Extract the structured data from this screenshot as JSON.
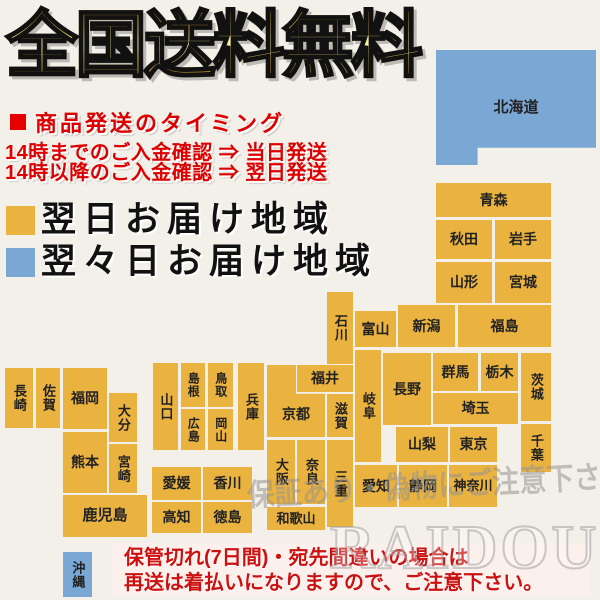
{
  "title": "全国送料無料",
  "shipping": {
    "heading": "商品発送のタイミング",
    "line1": "14時までのご入金確認 ⇒ 当日発送",
    "line2": "14時以降のご入金確認 ⇒ 翌日発送"
  },
  "legend": {
    "next_day": {
      "label": "翌日お届け地域",
      "color": "#eab23f"
    },
    "two_days": {
      "label": "翌々日お届け地域",
      "color": "#7ba7d5"
    }
  },
  "watermark": {
    "brush_text": "保証あり・偽物にご注意下さい",
    "brand_text": "RAIDOU"
  },
  "notice": {
    "line1": "保管切れ(7日間)・宛先間違いの場合は",
    "line2": "再送は着払いになりますので、ご注意下さい。"
  },
  "map": {
    "colors": {
      "orange": "#eab23f",
      "blue": "#7ba7d5"
    },
    "regions": [
      {
        "id": "hokkaido",
        "label": "北海道",
        "x": 436,
        "y": 50,
        "w": 160,
        "h": 115,
        "color": "blue",
        "orient": "h",
        "fs": 15,
        "clip": "hokkaido"
      },
      {
        "id": "aomori",
        "label": "青森",
        "x": 436,
        "y": 183,
        "w": 115,
        "h": 34
      },
      {
        "id": "akita",
        "label": "秋田",
        "x": 436,
        "y": 220,
        "w": 56,
        "h": 39
      },
      {
        "id": "iwate",
        "label": "岩手",
        "x": 495,
        "y": 220,
        "w": 56,
        "h": 39
      },
      {
        "id": "yamagata",
        "label": "山形",
        "x": 436,
        "y": 262,
        "w": 56,
        "h": 41
      },
      {
        "id": "miyagi",
        "label": "宮城",
        "x": 495,
        "y": 262,
        "w": 56,
        "h": 41
      },
      {
        "id": "niigata",
        "label": "新潟",
        "x": 398,
        "y": 305,
        "w": 57,
        "h": 42
      },
      {
        "id": "fukushima",
        "label": "福島",
        "x": 458,
        "y": 305,
        "w": 93,
        "h": 42
      },
      {
        "id": "toyama",
        "label": "富山",
        "x": 355,
        "y": 311,
        "w": 41,
        "h": 36
      },
      {
        "id": "ishikawa",
        "label": "石川",
        "x": 327,
        "y": 292,
        "w": 26,
        "h": 72,
        "orient": "v",
        "fs": 13
      },
      {
        "id": "gunma",
        "label": "群馬",
        "x": 433,
        "y": 353,
        "w": 45,
        "h": 38
      },
      {
        "id": "tochigi",
        "label": "栃木",
        "x": 481,
        "y": 353,
        "w": 37,
        "h": 38
      },
      {
        "id": "ibaraki",
        "label": "茨城",
        "x": 521,
        "y": 353,
        "w": 30,
        "h": 68,
        "orient": "v",
        "fs": 13
      },
      {
        "id": "saitama",
        "label": "埼玉",
        "x": 433,
        "y": 393,
        "w": 85,
        "h": 31
      },
      {
        "id": "chiba",
        "label": "千葉",
        "x": 521,
        "y": 424,
        "w": 30,
        "h": 48,
        "orient": "v",
        "fs": 13
      },
      {
        "id": "nagano",
        "label": "長野",
        "x": 383,
        "y": 353,
        "w": 48,
        "h": 72
      },
      {
        "id": "gifu",
        "label": "岐阜",
        "x": 355,
        "y": 350,
        "w": 26,
        "h": 112,
        "orient": "v",
        "fs": 13
      },
      {
        "id": "yamanashi",
        "label": "山梨",
        "x": 396,
        "y": 427,
        "w": 52,
        "h": 35
      },
      {
        "id": "tokyo",
        "label": "東京",
        "x": 450,
        "y": 427,
        "w": 47,
        "h": 35
      },
      {
        "id": "aichi",
        "label": "愛知",
        "x": 355,
        "y": 465,
        "w": 42,
        "h": 42
      },
      {
        "id": "shizuoka",
        "label": "静岡",
        "x": 399,
        "y": 465,
        "w": 48,
        "h": 42
      },
      {
        "id": "kanagawa",
        "label": "神奈川",
        "x": 449,
        "y": 465,
        "w": 48,
        "h": 42,
        "fs": 13
      },
      {
        "id": "fukui",
        "label": "福井",
        "x": 297,
        "y": 365,
        "w": 56,
        "h": 27
      },
      {
        "id": "kyoto",
        "label": "京都",
        "x": 267,
        "y": 365,
        "w": 58,
        "h": 72,
        "clip": "kyoto"
      },
      {
        "id": "shiga",
        "label": "滋賀",
        "x": 327,
        "y": 394,
        "w": 26,
        "h": 43,
        "orient": "v",
        "fs": 13
      },
      {
        "id": "osaka",
        "label": "大阪",
        "x": 267,
        "y": 440,
        "w": 28,
        "h": 64,
        "orient": "v",
        "fs": 13
      },
      {
        "id": "nara",
        "label": "奈良",
        "x": 297,
        "y": 440,
        "w": 28,
        "h": 64,
        "orient": "v",
        "fs": 13
      },
      {
        "id": "mie",
        "label": "三重",
        "x": 327,
        "y": 440,
        "w": 26,
        "h": 87,
        "orient": "v",
        "fs": 13
      },
      {
        "id": "wakayama",
        "label": "和歌山",
        "x": 267,
        "y": 507,
        "w": 58,
        "h": 23,
        "fs": 13
      },
      {
        "id": "hyogo",
        "label": "兵庫",
        "x": 238,
        "y": 363,
        "w": 26,
        "h": 87,
        "orient": "v",
        "fs": 13
      },
      {
        "id": "yamaguchi",
        "label": "山口",
        "x": 153,
        "y": 363,
        "w": 25,
        "h": 87,
        "orient": "v",
        "fs": 13
      },
      {
        "id": "shimane",
        "label": "島根",
        "x": 181,
        "y": 363,
        "w": 24,
        "h": 44,
        "orient": "v",
        "fs": 12
      },
      {
        "id": "tottori",
        "label": "鳥取",
        "x": 208,
        "y": 363,
        "w": 25,
        "h": 44,
        "orient": "v",
        "fs": 12
      },
      {
        "id": "hiroshima",
        "label": "広島",
        "x": 181,
        "y": 409,
        "w": 24,
        "h": 41,
        "orient": "v",
        "fs": 12
      },
      {
        "id": "okayama",
        "label": "岡山",
        "x": 208,
        "y": 409,
        "w": 25,
        "h": 41,
        "orient": "v",
        "fs": 12
      },
      {
        "id": "ehime",
        "label": "愛媛",
        "x": 152,
        "y": 467,
        "w": 49,
        "h": 33
      },
      {
        "id": "kagawa",
        "label": "香川",
        "x": 203,
        "y": 467,
        "w": 49,
        "h": 33
      },
      {
        "id": "kochi",
        "label": "高知",
        "x": 152,
        "y": 502,
        "w": 49,
        "h": 31
      },
      {
        "id": "tokushima",
        "label": "徳島",
        "x": 203,
        "y": 502,
        "w": 49,
        "h": 31
      },
      {
        "id": "nagasaki",
        "label": "長崎",
        "x": 5,
        "y": 368,
        "w": 28,
        "h": 60,
        "orient": "v",
        "fs": 13
      },
      {
        "id": "saga",
        "label": "佐賀",
        "x": 36,
        "y": 368,
        "w": 24,
        "h": 60,
        "orient": "v",
        "fs": 13
      },
      {
        "id": "fukuoka",
        "label": "福岡",
        "x": 63,
        "y": 368,
        "w": 44,
        "h": 61
      },
      {
        "id": "oita",
        "label": "大分",
        "x": 109,
        "y": 393,
        "w": 28,
        "h": 49,
        "orient": "v",
        "fs": 13
      },
      {
        "id": "kumamoto",
        "label": "熊本",
        "x": 63,
        "y": 432,
        "w": 44,
        "h": 61
      },
      {
        "id": "miyazaki",
        "label": "宮崎",
        "x": 109,
        "y": 444,
        "w": 28,
        "h": 49,
        "orient": "v",
        "fs": 13
      },
      {
        "id": "kagoshima",
        "label": "鹿児島",
        "x": 63,
        "y": 495,
        "w": 84,
        "h": 42,
        "fs": 15
      },
      {
        "id": "okinawa",
        "label": "沖縄",
        "x": 63,
        "y": 552,
        "w": 29,
        "h": 45,
        "color": "blue",
        "orient": "v",
        "fs": 13
      }
    ]
  }
}
